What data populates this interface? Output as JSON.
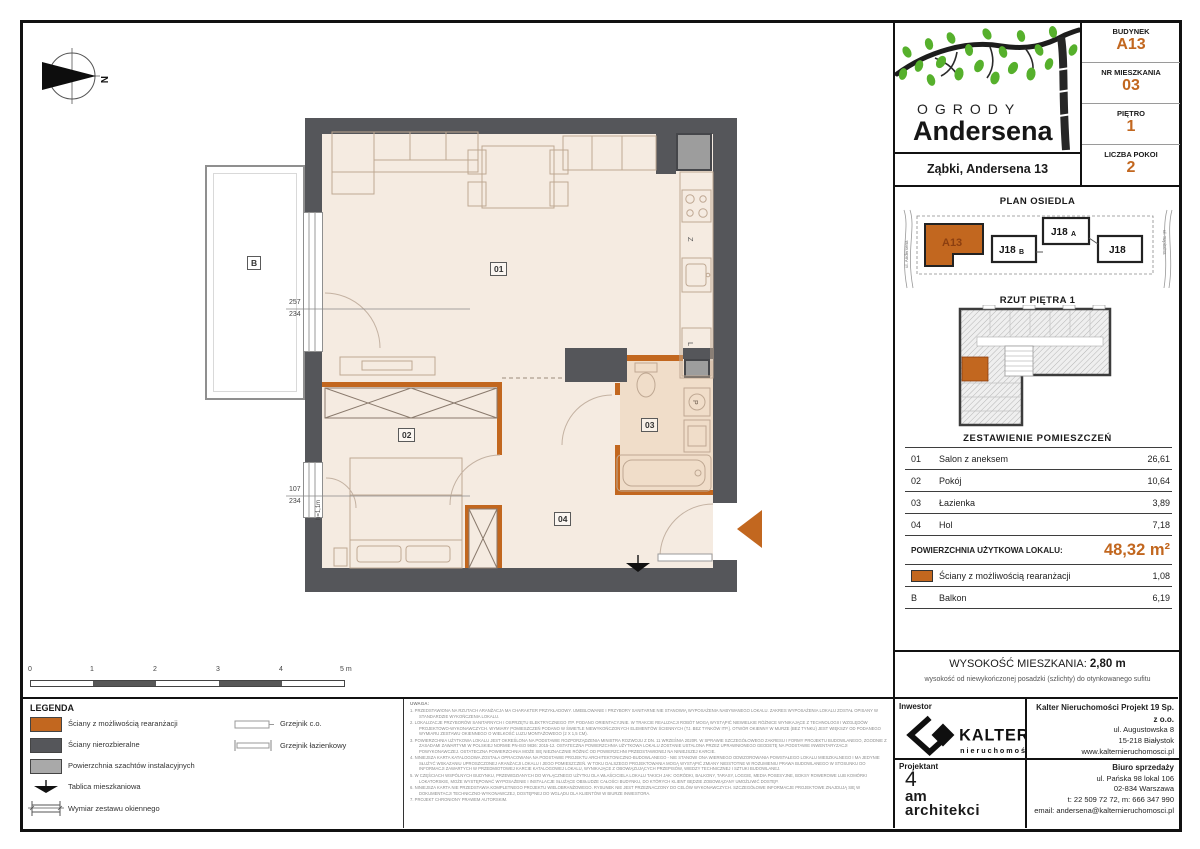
{
  "header": {
    "rows": [
      {
        "label": "BUDYNEK",
        "value": "A13"
      },
      {
        "label": "NR MIESZKANIA",
        "value": "03"
      },
      {
        "label": "PIĘTRO",
        "value": "1"
      },
      {
        "label": "LICZBA POKOI",
        "value": "2"
      }
    ]
  },
  "logo": {
    "top": "OGRODY",
    "bottom": "Andersena"
  },
  "address_bar": {
    "text": "Ząbki, Andersena 13"
  },
  "site_plan": {
    "title": "PLAN OSIEDLA",
    "blocks": [
      {
        "name": "A13",
        "suffix": ""
      },
      {
        "name": "J18",
        "suffix": "B"
      },
      {
        "name": "J18",
        "suffix": "A"
      },
      {
        "name": "J18",
        "suffix": ""
      }
    ],
    "street_left": "ul. Andersena",
    "street_right": "ul. Szpitalna"
  },
  "floor_thumb": {
    "title": "RZUT PIĘTRA 1"
  },
  "rooms_table": {
    "title": "ZESTAWIENIE POMIESZCZEŃ",
    "rows": [
      {
        "no": "01",
        "name": "Salon z aneksem",
        "area": "26,61"
      },
      {
        "no": "02",
        "name": "Pokój",
        "area": "10,64"
      },
      {
        "no": "03",
        "name": "Łazienka",
        "area": "3,89"
      },
      {
        "no": "04",
        "name": "Hol",
        "area": "7,18"
      }
    ],
    "total_label": "POWIERZCHNIA UŻYTKOWA LOKALU:",
    "total_value": "48,32 m²",
    "wall_row": {
      "name": "Ściany z możliwością rearanżacji",
      "area": "1,08"
    },
    "balcony_row": {
      "no": "B",
      "name": "Balkon",
      "area": "6,19"
    }
  },
  "height_info": {
    "label": "WYSOKOŚĆ MIESZKANIA:",
    "value": "2,80 m",
    "note": "wysokość od niewykończonej posadzki (szlichty) do otynkowanego sufitu"
  },
  "investor": {
    "label": "Inwestor",
    "brand": "KALTER",
    "brand_sub": "nieruchomości",
    "company": "Kalter Nieruchomości Projekt 19 Sp. z o.o.",
    "address1": "ul. Augustowska 8",
    "address2": "15-218 Białystok",
    "www": "www.kalternieruchomosci.pl"
  },
  "designer": {
    "label": "Projektant",
    "logo1": "4",
    "logo2": "am",
    "logo3": "architekci"
  },
  "sales": {
    "label": "Biuro sprzedaży",
    "address1": "ul. Pańska 98 lokal 106",
    "address2": "02-834 Warszawa",
    "phones": "t: 22 509 72 72, m: 666 347 990",
    "email": "email: andersena@kalternieruchomosci.pl"
  },
  "legend": {
    "title": "LEGENDA",
    "items": [
      "Ściany z możliwością rearanżacji",
      "Ściany nierozbieralne",
      "Powierzchnia szachtów instalacyjnych",
      "Tablica mieszkaniowa",
      "Wymiar zestawu okiennego"
    ],
    "items2": [
      "Grzejnik c.o.",
      "Grzejnik łazienkowy"
    ]
  },
  "scalebar": {
    "labels": [
      "0",
      "1",
      "2",
      "3",
      "4",
      "5 m"
    ]
  },
  "notes": {
    "title": "UWAGA:",
    "items": [
      "1. PRZEDSTAWIONA NA RZUTACH ARANŻACJA MA CHARAKTER PRZYKŁADOWY. UMEBLOWANIE I PRZYBORY SANITARNE NIE STANOWIĄ WYPOSAŻENIA NABYWANEGO LOKALU. ZAKRES WYPOSAŻENIA LOKALU ZOSTAŁ OPISANY W STANDARDZIE WYKOŃCZENIA LOKALU.",
      "2. LOKALIZACJE PRZYBORÓW SANITARNYCH I OSPRZĘTU ELEKTRYCZNEGO ITP. PODANO ORIENTACYJNIE. W TRAKCIE REALIZACJI ROBÓT MOGĄ WYSTĄPIĆ NIEWIELKIE RÓŻNICE WYNIKAJĄCE Z TECHNOLOGII I WZGLĘDÓW PROJEKTOWO-WYKONAWCZYCH. WYMIARY POMIESZCZEŃ PODANO W ŚWIETLE NIEWYKOŃCZONYCH ELEMENTÓW ŚCIENNYCH (TJ. BEZ TYNKÓW ITP.). OTWÓR OKIENNY W MURZE (BEZ TYNKU) JEST WIĘKSZY OD PODANEGO WYMIARU ZESTAWU OKIENNEGO O WIELKOŚĆ LUZU MONTAŻOWEGO (2 X 1,5 CM).",
      "3. POWIERZCHNIA UŻYTKOWA LOKALU JEST OKREŚLONA NA PODSTAWIE ROZPORZĄDZENIA MINISTRA ROZWOJU Z DN. 11 WRZEŚNIA 2020R. W SPRAWIE SZCZEGÓŁOWEGO ZAKRESU I FORMY PROJEKTU BUDOWLANEGO, ZGODNIE Z ZASADAMI ZAWARTYMI W POLSKIEJ NORMIE PN-ISO 9836: 2015-12. OSTATECZNA POWIERZCHNIA UŻYTKOWA LOKALU ZOSTANIE USTALONA PRZEZ UPRAWNIONEGO GEODETĘ NA PODSTAWIE INWENTARYZACJI POWYKONAWCZEJ. OSTATECZNA POWIERZCHNIA MOŻE SIĘ NIEZNACZNIE RÓŻNIĆ OD POWIERZCHNI PRZEDSTAWIONEJ NA NINIEJSZEJ KARCIE.",
      "4. NINIEJSZA KARTA KATALOGOWA ZOSTAŁA OPRACOWANA NA PODSTAWIE PROJEKTU ARCHITEKTONICZNO-BUDOWLANEGO - NIE STANOWI ONA WIERNEGO ODWZOROWANIA POWSTAŁEGO LOKALU MIESZKALNEGO I MA JEDYNIE SŁUŻYĆ WSKAZANIU UPROSZCZONEJ ARANŻACJI LOKALU I JEGO POMIESZCZEŃ. W TOKU DALSZEGO PROJEKTOWANIA MOGĄ WYSTĄPIĆ ZMIANY NIEISTOTNE W ROZUMIENIU PRAWA BUDOWLANEGO W STOSUNKU DO INFORMACJI ZAWARTYCH W PRZEDMIOTOWEJ KARCIE KATALOGOWEJ LOKALU, WYNIKAJĄCE Z OBOWIĄZUJĄCYCH PRZEPISÓW, WIEDZY TECHNICZNEJ I SZTUKI BUDOWLANEJ.",
      "5. W CZĘŚCIACH WSPÓLNYCH BUDYNKU, PRZEWIDZIANYCH DO WYŁĄCZNEGO UŻYTKU DLA WŁAŚCICIELA LOKALU TAKICH JAK: OGRÓDKI, BALKONY, TARASY, LOGGIE, MEDIA POSESYJNE, BOKSY ROWEROWE LUB KOMÓRKI LOKATORSKIE, MOŻE WYSTĘPOWAĆ WYPOSAŻENIE I INSTALACJE SŁUŻĄCE OBSŁUDZE CAŁOŚCI BUDYNKU, DO KTÓRYCH KLIENT BĘDZIE ZOBOWIĄZANY UMOŻLIWIĆ DOSTĘP.",
      "6. NINIEJSZA KARTA NIE PRZEDSTAWIA KOMPLETNEGO PROJEKTU WIELOBRANŻOWEGO. RYSUNEK NIE JEST PRZEZNACZONY DO CELÓW WYKONAWCZYCH. SZCZEGÓŁOWE INFORMACJE PROJEKTOWE ZNAJDUJĄ SIĘ W DOKUMENTACJI TECHNICZNO-WYKONAWCZEJ, DOSTĘPNEJ DO WGLĄDU DLA KLIENTÓW W BIURZE INWESTORA.",
      "7. PROJEKT CHRONIONY PRAWEM AUTORSKIM."
    ]
  },
  "plan": {
    "labels": {
      "r01": "01",
      "r02": "02",
      "r03": "03",
      "r04": "04",
      "balcony": "B"
    },
    "dims": {
      "win1_top": "257",
      "win1_bottom": "234",
      "win2_top": "107",
      "win2_bottom": "234",
      "sill": "h=1,1m"
    },
    "letters": {
      "dishwasher": "Z",
      "fridge": "L",
      "washer": "P",
      "north": "N"
    }
  },
  "colors": {
    "accent": "#c2671f",
    "wall": "#57575a",
    "floor": "#f5ebe1"
  }
}
